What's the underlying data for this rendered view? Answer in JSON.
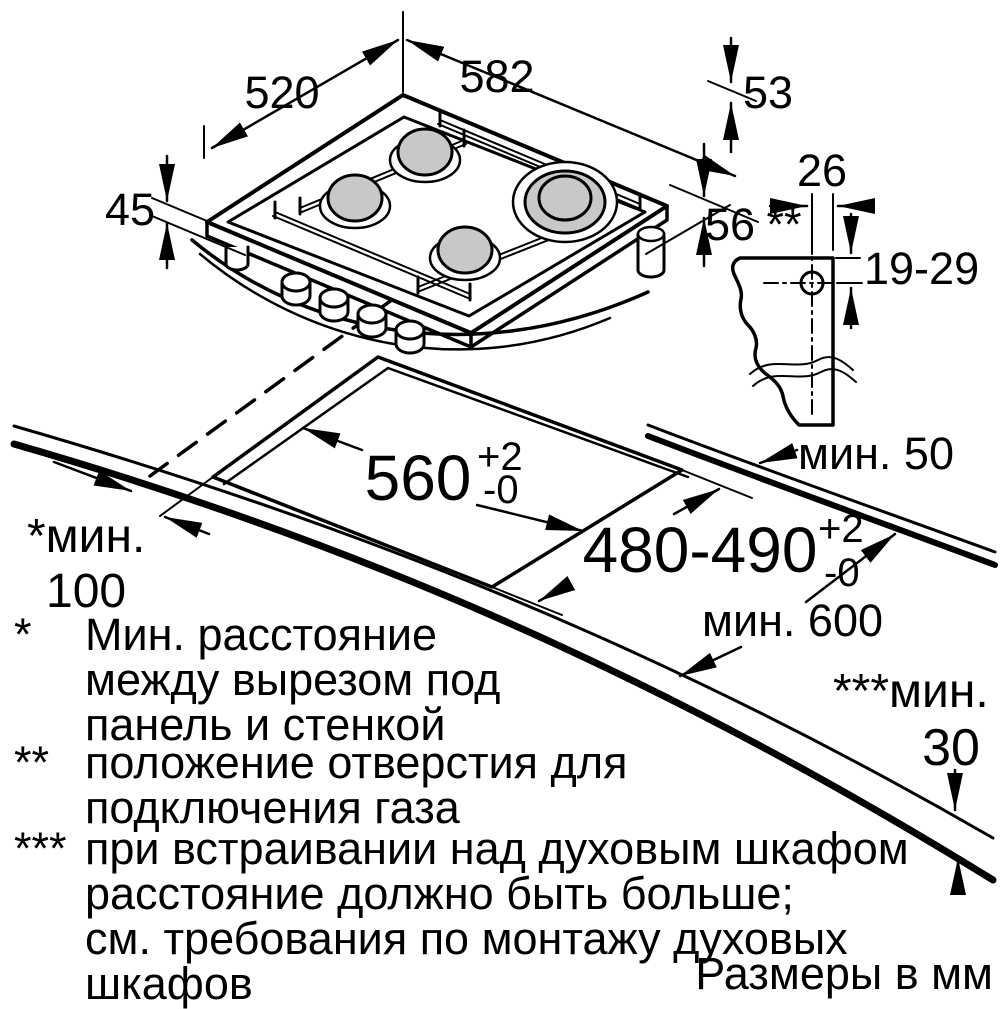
{
  "drawing": {
    "hob": {
      "width": "582",
      "depth": "520",
      "height": "45",
      "edge_53": "53",
      "edge_56": "56"
    },
    "gas": {
      "offset": "26",
      "marker": "**",
      "range": "19-29"
    },
    "cutout": {
      "width": "560",
      "width_plus": "+2",
      "width_minus": "-0",
      "depth": "480-490",
      "depth_plus": "+2",
      "depth_minus": "-0"
    },
    "clearances": {
      "rear": "мин. 50",
      "depth_min": "мин. 600",
      "wall_line1": "*мин.",
      "wall_line2": "100",
      "oven_line1": "***мин.",
      "oven_line2": "30"
    }
  },
  "footnotes": [
    {
      "marker": "*",
      "lines": [
        "Мин. расстояние",
        "между вырезом под",
        "панель и стенкой"
      ]
    },
    {
      "marker": "**",
      "lines": [
        "положение отверстия для",
        "подключения газа"
      ]
    },
    {
      "marker": "***",
      "lines": [
        "при встраивании над духовым шкафом",
        "расстояние должно быть больше;",
        "см. требования по монтажу духовых",
        "шкафов"
      ]
    }
  ],
  "footer": {
    "units_note": "Размеры в мм"
  },
  "colors": {
    "line": "#000000",
    "burner_fill": "#c8c8c8",
    "background": "#ffffff"
  }
}
